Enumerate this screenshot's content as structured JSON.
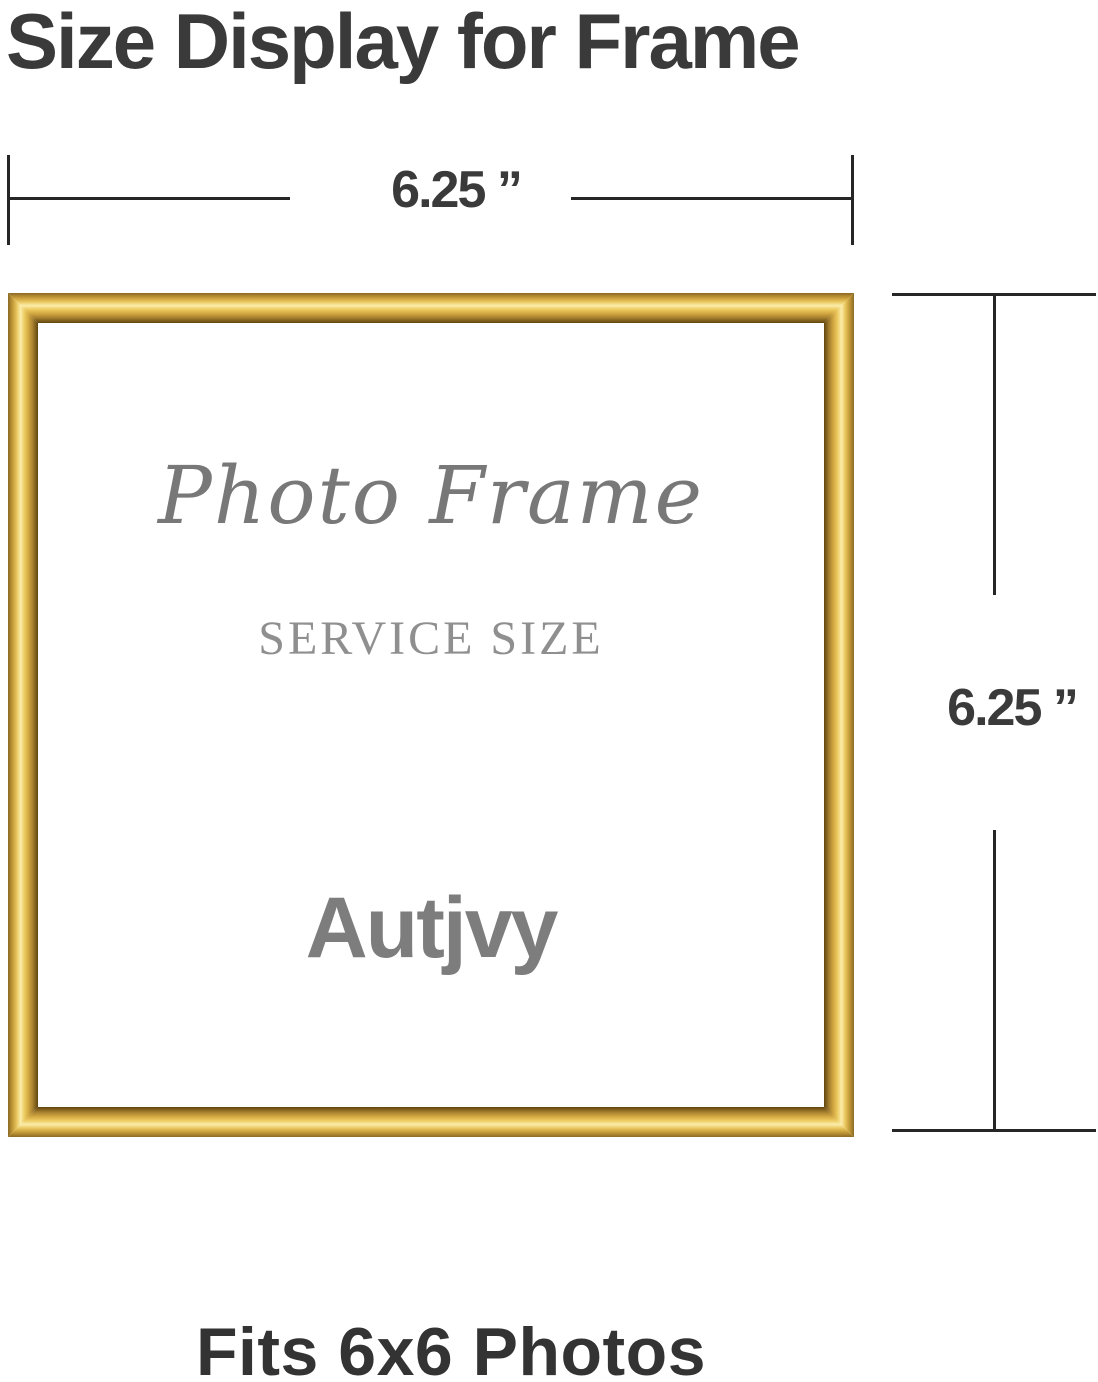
{
  "title": "Size Display for Frame",
  "top_dimension": {
    "label": "6.25 ”"
  },
  "right_dimension": {
    "label": "6.25 ”"
  },
  "frame": {
    "script_text": "Photo Frame",
    "engraved_text": "SERVICE SIZE",
    "brand_text": "Autjvy"
  },
  "footer": {
    "caption": "Fits 6x6 Photos"
  },
  "colors": {
    "gold_highlight": "#fbedaa",
    "gold_mid": "#e0b84d",
    "gold_shadow": "#7c5c1a",
    "title_text": "#3a3a3a",
    "interior_text_gray": "#808080",
    "dimension_line": "#262626"
  }
}
